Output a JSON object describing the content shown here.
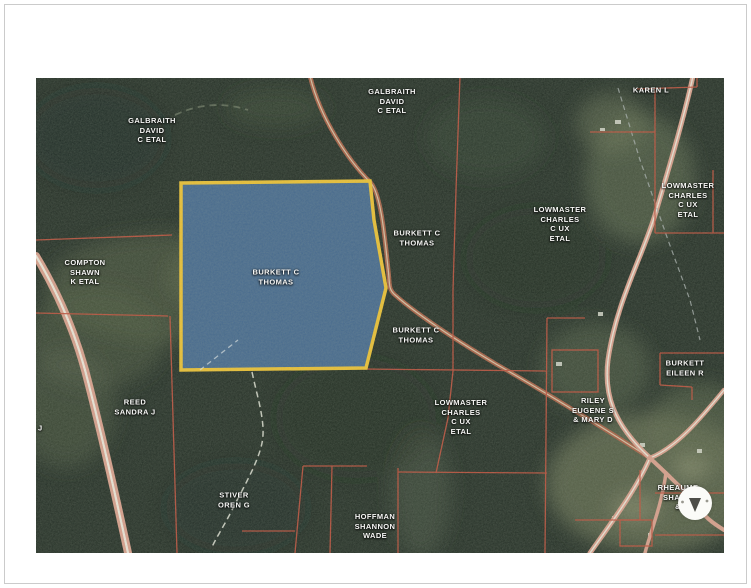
{
  "page": {
    "background": "#ffffff",
    "frame_color": "#cbcbcb"
  },
  "map": {
    "type": "aerial-parcel-map",
    "highlight": {
      "owner": "BURKETT C THOMAS",
      "fill": "#41658d",
      "border": "#f0c12e"
    },
    "colors": {
      "parcel_line": "#c24b38",
      "road": "#dc9e8c",
      "forest": "#202a22",
      "label_text": "#ffffff"
    },
    "labels": {
      "galbraith_west": {
        "lines": [
          "GALBRAITH",
          "DAVID",
          "C ETAL"
        ]
      },
      "galbraith_north": {
        "lines": [
          "GALBRAITH",
          "DAVID",
          "C ETAL"
        ]
      },
      "karen": {
        "lines": [
          "KAREN L"
        ]
      },
      "lowmaster_east": {
        "lines": [
          "LOWMASTER",
          "CHARLES",
          "C UX",
          "ETAL"
        ]
      },
      "lowmaster_central": {
        "lines": [
          "LOWMASTER",
          "CHARLES",
          "C UX",
          "ETAL"
        ]
      },
      "burkett_thomas_north": {
        "lines": [
          "BURKETT C",
          "THOMAS"
        ]
      },
      "burkett_thomas_highlight": {
        "lines": [
          "BURKETT C",
          "THOMAS"
        ]
      },
      "compton": {
        "lines": [
          "COMPTON",
          "SHAWN",
          "K ETAL"
        ]
      },
      "burkett_thomas_south": {
        "lines": [
          "BURKETT C",
          "THOMAS"
        ]
      },
      "reed": {
        "lines": [
          "REED",
          "SANDRA J"
        ]
      },
      "edge_fragment": {
        "lines": [
          "A J"
        ]
      },
      "stiver": {
        "lines": [
          "STIVER",
          "OREN G"
        ]
      },
      "hoffman": {
        "lines": [
          "HOFFMAN",
          "SHANNON",
          "WADE"
        ]
      },
      "lowmaster_south": {
        "lines": [
          "LOWMASTER",
          "CHARLES",
          "C UX",
          "ETAL"
        ]
      },
      "riley": {
        "lines": [
          "RILEY",
          "EUGENE S",
          "& MARY D"
        ]
      },
      "burkett_eileen": {
        "lines": [
          "BURKETT",
          "EILEEN R"
        ]
      },
      "rheaume": {
        "lines": [
          "RHEAUME",
          "SHAWN",
          "&"
        ]
      }
    },
    "marker": {
      "type": "circle-pointer",
      "fill": "#fbfbf8",
      "arrow_color": "#4d4d48"
    }
  }
}
